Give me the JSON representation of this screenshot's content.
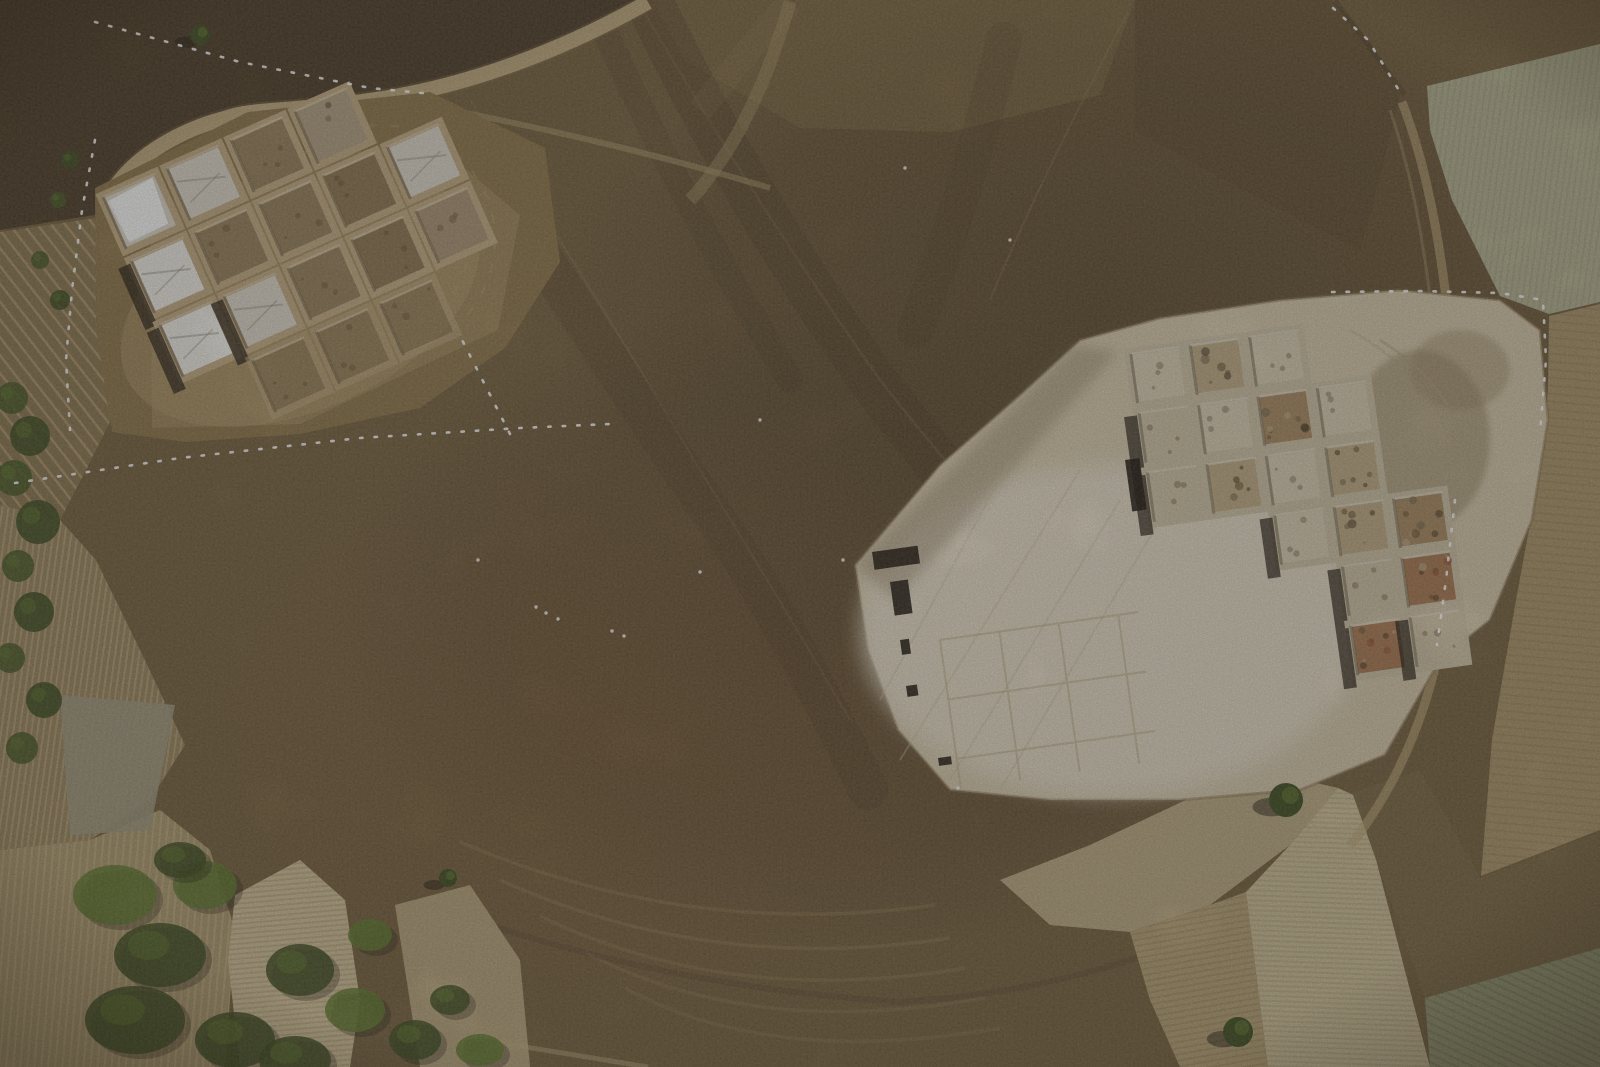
{
  "scene": {
    "type": "aerial-photograph",
    "subject": "top-down drone view of a large brown tell mound with two archaeological excavation grids, surrounded by harvested and plowed farm fields, dirt tracks, fence lines and patches of green vegetation"
  },
  "palette": {
    "base": "#75613e",
    "scrub": "#4c3d27",
    "vineyard": "#8a7650",
    "field_striped_a": "#9b865f",
    "field_striped_b": "#ad9a6e",
    "gray_patch": "#a29a80",
    "pale_strip": "#d3c29a",
    "second_strip": "#c2af86",
    "tan_field": "#b6a173",
    "pale_wedge": "#cfc09a",
    "gray_green": "#969873",
    "stubble_dark": "#7a6743",
    "east_field": "#ab9568",
    "corner_field": "#b6b493",
    "se_band": "#c3b189",
    "shoulder": "#8e764a",
    "clearing_left": "#a28a5c",
    "clearing_left_bright": "#b39a6c",
    "clearing_right": "#d6c9ab",
    "clearing_bright": "#e8decc",
    "balk": "#c3ac82",
    "balk_right": "#cfc2a5",
    "road": "#c9b184",
    "track": "#bfa878",
    "band_dark": "#4a3823",
    "arc_light": "#a88c5f",
    "fence_white": "#ffffff",
    "tarp_bright": "#f2efe8",
    "tarp_gray": "#ded8ca",
    "soil": "#97805a",
    "soil_dark": "#8d7650",
    "pale": "#d9cdb2",
    "pale2": "#cfc2a4",
    "mixed": "#ab9373",
    "rubble": "#c0aa84",
    "rubble_dark": "#a88a60",
    "rubble_red": "#a87850",
    "faint": "#8b7451",
    "topsq": "#b3a183",
    "tree_green": "#3f4e20",
    "tree_light": "#617a2e",
    "shadow": "#221a10",
    "trench_dark": "#241c12"
  },
  "left_excavation": {
    "origin": [
      100,
      196
    ],
    "rotation": -24,
    "pitch": 70,
    "cell": 61,
    "cells": [
      {
        "r": 0,
        "c": 0,
        "t": "tarp_gray"
      },
      {
        "r": 0,
        "c": 1,
        "t": "tarp_gray"
      },
      {
        "r": 0,
        "c": 2,
        "t": "soil"
      },
      {
        "r": 0,
        "c": 3,
        "t": "topsq"
      },
      {
        "r": 1,
        "c": 0,
        "t": "tarp_bright"
      },
      {
        "r": 1,
        "c": 1,
        "t": "soil"
      },
      {
        "r": 1,
        "c": 2,
        "t": "soil"
      },
      {
        "r": 1,
        "c": 3,
        "t": "soil_dark"
      },
      {
        "r": 1,
        "c": 4,
        "t": "tarp_gray"
      },
      {
        "r": 2,
        "c": 0,
        "t": "tarp_bright"
      },
      {
        "r": 2,
        "c": 1,
        "t": "tarp_gray"
      },
      {
        "r": 2,
        "c": 2,
        "t": "soil"
      },
      {
        "r": 2,
        "c": 3,
        "t": "soil_dark"
      },
      {
        "r": 2,
        "c": 4,
        "t": "mixed"
      },
      {
        "r": 3,
        "c": 1,
        "t": "faint"
      },
      {
        "r": 3,
        "c": 2,
        "t": "faint"
      },
      {
        "r": 3,
        "c": 3,
        "t": "faint"
      }
    ],
    "shadow_cells": [
      [
        1,
        0
      ],
      [
        2,
        0
      ],
      [
        2,
        1
      ]
    ]
  },
  "right_excavation": {
    "origin": [
      1128,
      352
    ],
    "rotation": -8,
    "pitch": 60,
    "cell": 54,
    "cells": [
      {
        "r": 0,
        "c": 0,
        "t": "pale"
      },
      {
        "r": 0,
        "c": 1,
        "t": "rubble"
      },
      {
        "r": 0,
        "c": 2,
        "t": "pale"
      },
      {
        "r": 1,
        "c": 0,
        "t": "pale2"
      },
      {
        "r": 1,
        "c": 1,
        "t": "pale"
      },
      {
        "r": 1,
        "c": 2,
        "t": "rubble_dark"
      },
      {
        "r": 1,
        "c": 3,
        "t": "pale"
      },
      {
        "r": 2,
        "c": 0,
        "t": "pale2"
      },
      {
        "r": 2,
        "c": 1,
        "t": "rubble"
      },
      {
        "r": 2,
        "c": 2,
        "t": "pale"
      },
      {
        "r": 2,
        "c": 3,
        "t": "rubble"
      },
      {
        "r": 3,
        "c": 2,
        "t": "pale"
      },
      {
        "r": 3,
        "c": 3,
        "t": "rubble"
      },
      {
        "r": 3,
        "c": 4,
        "t": "rubble_dark"
      },
      {
        "r": 4,
        "c": 3,
        "t": "pale2"
      },
      {
        "r": 4,
        "c": 4,
        "t": "rubble_red"
      },
      {
        "r": 5,
        "c": 3,
        "t": "rubble_red"
      },
      {
        "r": 5,
        "c": 4,
        "t": "pale2"
      }
    ],
    "shadow_cells": [
      [
        1,
        0
      ],
      [
        2,
        0
      ],
      [
        3,
        2
      ],
      [
        4,
        3
      ],
      [
        5,
        3
      ],
      [
        5,
        4
      ]
    ],
    "dark_trenches": [
      [
        872,
        552,
        46,
        18
      ],
      [
        890,
        582,
        18,
        34
      ],
      [
        1125,
        460,
        20,
        52
      ],
      [
        900,
        640,
        9,
        15
      ],
      [
        906,
        686,
        11,
        11
      ],
      [
        938,
        758,
        13,
        8
      ]
    ]
  },
  "trees": [
    [
      1286,
      800,
      17
    ],
    [
      1238,
      1032,
      15
    ],
    [
      200,
      35,
      10
    ],
    [
      448,
      878,
      9
    ]
  ],
  "left_edge_vegetation": [
    [
      12,
      398,
      16
    ],
    [
      30,
      436,
      20
    ],
    [
      14,
      478,
      18
    ],
    [
      38,
      522,
      22
    ],
    [
      18,
      566,
      16
    ],
    [
      34,
      612,
      20
    ],
    [
      10,
      658,
      15
    ],
    [
      44,
      700,
      18
    ],
    [
      22,
      748,
      16
    ],
    [
      60,
      300,
      10
    ],
    [
      40,
      260,
      9
    ],
    [
      70,
      160,
      9
    ],
    [
      58,
      200,
      8
    ]
  ],
  "bottom_vegetation": [
    [
      115,
      895,
      42,
      30
    ],
    [
      160,
      955,
      46,
      32
    ],
    [
      135,
      1020,
      50,
      34
    ],
    [
      205,
      885,
      32,
      24
    ],
    [
      235,
      1040,
      40,
      28
    ],
    [
      300,
      970,
      34,
      26
    ],
    [
      355,
      1010,
      30,
      22
    ],
    [
      415,
      1040,
      26,
      20
    ],
    [
      295,
      1060,
      36,
      24
    ],
    [
      370,
      935,
      22,
      16
    ],
    [
      450,
      1000,
      20,
      15
    ],
    [
      180,
      860,
      26,
      18
    ],
    [
      480,
      1050,
      24,
      16
    ]
  ],
  "fences": [
    {
      "points": [
        [
          15,
          483
        ],
        [
          180,
          458
        ],
        [
          360,
          438
        ],
        [
          520,
          428
        ],
        [
          610,
          424
        ]
      ]
    },
    {
      "points": [
        [
          510,
          434
        ],
        [
          458,
          332
        ]
      ]
    },
    {
      "points": [
        [
          95,
          22
        ],
        [
          240,
          62
        ],
        [
          370,
          88
        ],
        [
          432,
          94
        ]
      ]
    },
    {
      "points": [
        [
          1332,
          292
        ],
        [
          1420,
          291
        ],
        [
          1500,
          293
        ],
        [
          1543,
          300
        ],
        [
          1546,
          360
        ],
        [
          1540,
          432
        ]
      ]
    },
    {
      "points": [
        [
          1333,
          8
        ],
        [
          1368,
          40
        ],
        [
          1400,
          92
        ]
      ]
    },
    {
      "points": [
        [
          1455,
          500
        ],
        [
          1446,
          580
        ],
        [
          1437,
          645
        ]
      ]
    },
    {
      "points": [
        [
          95,
          140
        ],
        [
          82,
          210
        ],
        [
          72,
          290
        ],
        [
          66,
          360
        ],
        [
          70,
          430
        ]
      ]
    }
  ],
  "white_specks": [
    [
      536,
      607
    ],
    [
      546,
      613
    ],
    [
      558,
      619
    ],
    [
      612,
      631
    ],
    [
      624,
      636
    ],
    [
      843,
      560
    ],
    [
      958,
      788
    ],
    [
      700,
      572
    ],
    [
      905,
      168
    ],
    [
      1010,
      240
    ],
    [
      760,
      420
    ],
    [
      478,
      560
    ]
  ]
}
